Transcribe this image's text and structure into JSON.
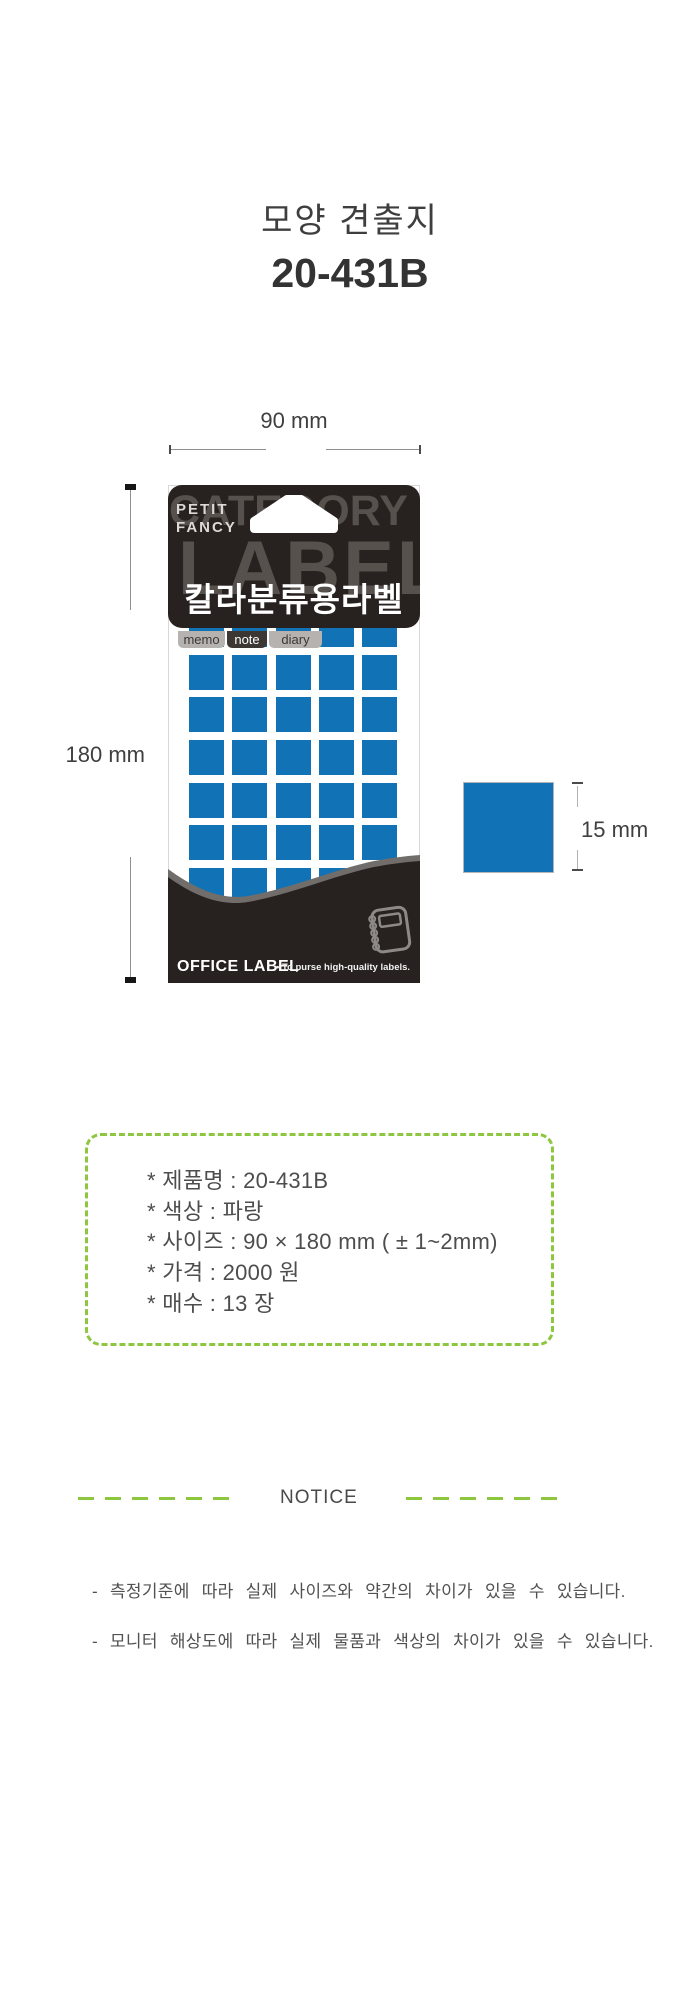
{
  "page": {
    "title": "모양 견출지",
    "model": "20-431B"
  },
  "dimension_annotations": {
    "width": "90 mm",
    "height": "180 mm",
    "label_size": "15 mm"
  },
  "package": {
    "brand": {
      "line1": "PETIT",
      "line2": "FANCY"
    },
    "background_words": {
      "word1": "CATEGORY",
      "word2": "LABEL"
    },
    "product_label": "칼라분류용라벨",
    "tabs": [
      "memo",
      "note",
      "diary"
    ],
    "grid": {
      "columns": 5,
      "rows": 7,
      "square_color": "#1173b6"
    },
    "footer": {
      "brand": "OFFICE LABEL",
      "tagline": "• To purse high-quality labels."
    }
  },
  "specs": {
    "items": [
      "* 제품명 : 20-431B",
      "* 색상 : 파랑",
      "* 사이즈 : 90 × 180 mm ( ± 1~2mm)",
      "* 가격 : 2000 원",
      "* 매수 : 13 장"
    ]
  },
  "notice": {
    "heading": "NOTICE",
    "notes": [
      "- 측정기준에 따라 실제 사이즈와 약간의 차이가 있을 수 있습니다.",
      "- 모니터 해상도에 따라 실제 물품과 색상의 차이가 있을 수 있습니다."
    ]
  },
  "colors": {
    "blue": "#1173b6",
    "green": "#8dc63f",
    "package_dark": "#27211f",
    "watermark_gray": "#57514e",
    "text_dark": "#3e3e3e"
  }
}
